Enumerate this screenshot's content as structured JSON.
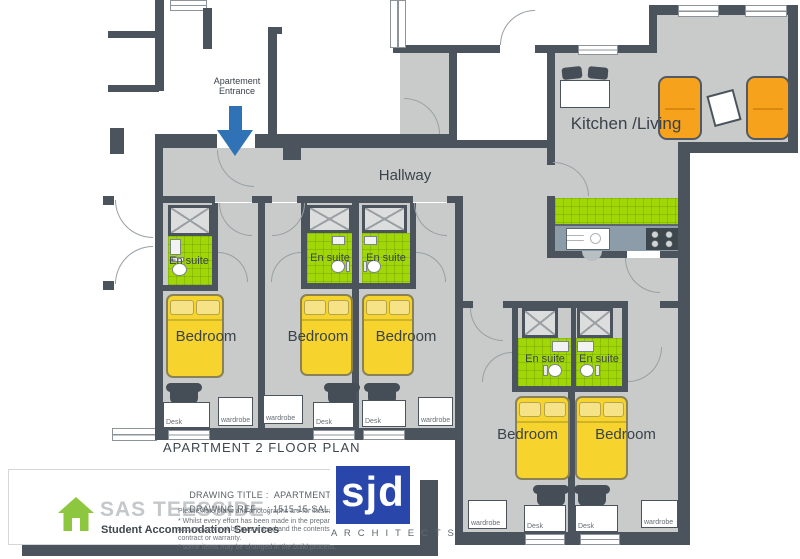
{
  "plan": {
    "caption": "APARTMENT 2 FLOOR PLAN",
    "labels": {
      "entrance_line1": "Apartement",
      "entrance_line2": "Entrance",
      "hallway": "Hallway",
      "kitchen_living": "Kitchen /Living",
      "en_suite": "En suite",
      "bedroom": "Bedroom",
      "desk": "Desk",
      "wardrobe": "wardrobe"
    },
    "colors": {
      "wall": "#4b545c",
      "floor": "#c8cbc9",
      "en_suite_green": "#a2d707",
      "bed_yellow": "#f6d42d",
      "sofa_orange": "#f6a21c",
      "arrow_blue": "#2f72b5",
      "sjd_blue": "#2946aa",
      "sas_green": "#8dc63f"
    }
  },
  "title_block": {
    "sas": {
      "name": "SAS TEESSIDE",
      "tagline": "Student Accommodation Services"
    },
    "drawing_title_label": "DRAWING TITLE :  ",
    "drawing_title_value": "APARTMENT  2",
    "drawing_ref_label": "DRAWING REF    : ",
    "drawing_ref_value": "1515-15-SALES - APARTMENT 2",
    "disclaimer": [
      "Please note plans and photographs are for illustrative purposes only.",
      "* Whilst every effort has been made in the preparation of information, accuracy cannot be guaranteed and the contents do not constitute as a contract or warranty.",
      "* some items may be changed in the build process."
    ],
    "sjd": {
      "logo_text": "sjd",
      "name": "A R C H I T E C T S"
    }
  }
}
